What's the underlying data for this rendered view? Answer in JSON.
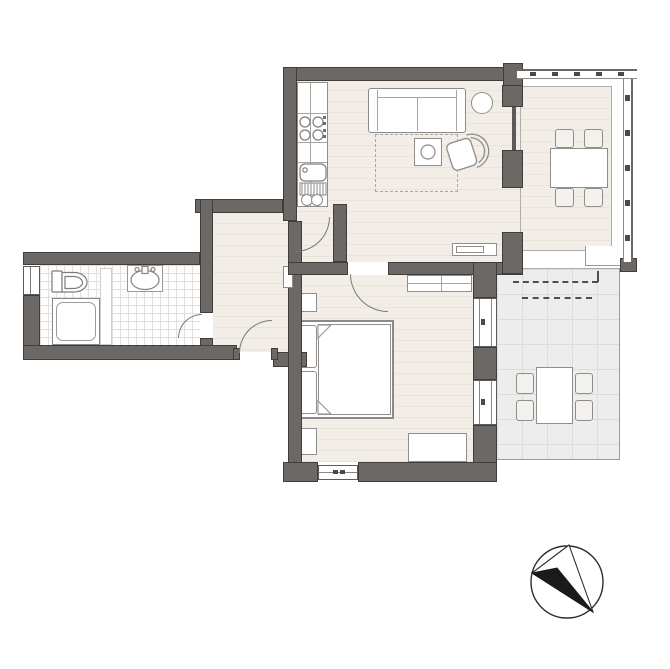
{
  "colors": {
    "wall": "#6c6866",
    "wall-outline": "#403d3b",
    "floor": "#f2eee7",
    "floor-stripe": "#e9e4db",
    "bath-bg": "#fdfdfd",
    "bath-line": "#e0e0e0",
    "terrace-bg": "#ededed",
    "terrace-line": "#dcdcdc",
    "furn": "#918d89",
    "arc": "#7a7a7a",
    "ink": "#1a1a1a"
  },
  "icons": {
    "compass": "north-arrow-icon"
  }
}
